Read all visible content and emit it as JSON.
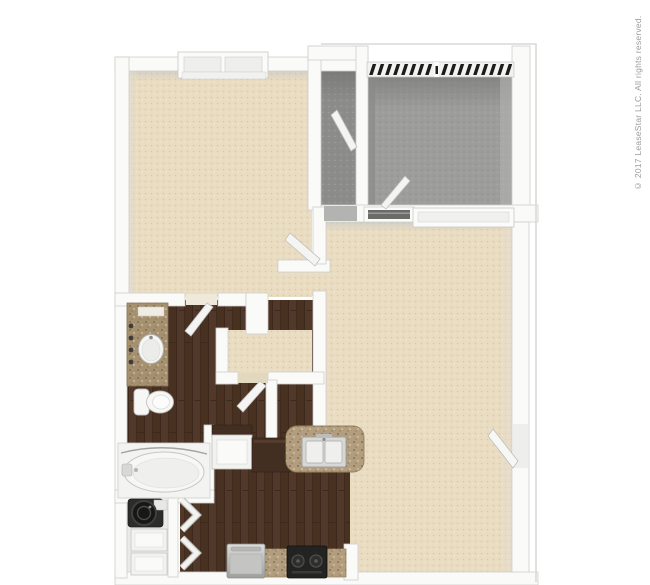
{
  "watermark": {
    "text": "© 2017 LeaseStar LLC. All rights reserved.",
    "color": "#9b9b9b"
  },
  "colors": {
    "page_bg": "#ffffff",
    "carpet": "#e9dcc1",
    "patio_floor": "#9d9d9b",
    "storage_floor": "#8c8c8a",
    "wood": "#4f372a",
    "wood_stripe": "#412c21",
    "granite": "#b29e7e",
    "vanity_granite": "#a5906f",
    "wall": "#fafaf8",
    "wall_stroke": "#cfcfcd",
    "wall_shade": "#c9c9c7",
    "railing_black": "#1c1c1c",
    "fixture_white": "#f6f6f4",
    "fixture_stroke": "#c2c2c0",
    "appliance_dark": "#232321",
    "appliance_steel": "#c9c9c7",
    "cabinet_dark": "#432e22",
    "sill_dark": "#6b6b69",
    "slab_outline": "#d9d9d7"
  },
  "floor_plan": {
    "type": "3d-top-down-floor-plan",
    "unit": "one-bedroom one-bath apartment",
    "rooms": [
      {
        "id": "bedroom",
        "floor": "beige carpet",
        "position": "top-left"
      },
      {
        "id": "storage-closet",
        "floor": "gray",
        "position": "top-center"
      },
      {
        "id": "patio",
        "floor": "gray concrete",
        "position": "top-right",
        "feature": "black railing"
      },
      {
        "id": "living-room",
        "floor": "beige carpet",
        "position": "right"
      },
      {
        "id": "walk-in-closet",
        "floor": "beige carpet",
        "position": "center-left"
      },
      {
        "id": "bathroom",
        "floor": "dark wood",
        "position": "left-middle"
      },
      {
        "id": "laundry-closet",
        "floor": "white",
        "position": "bottom-left"
      },
      {
        "id": "kitchen",
        "floor": "dark wood",
        "position": "bottom-center"
      }
    ],
    "fixtures": [
      "bedroom-window",
      "patio-railing",
      "patio-sliding-door",
      "living-room-window",
      "entry-door",
      "bedroom-door",
      "bathroom-door",
      "closet-door",
      "storage-closet-door",
      "laundry-bifold-doors",
      "vanity-counter",
      "vanity-sink",
      "toilet",
      "garden-bathtub",
      "washer",
      "dryer",
      "breakfast-bar",
      "kitchen-double-sink",
      "range",
      "refrigerator",
      "base-counter",
      "pantry-cabinet"
    ]
  }
}
